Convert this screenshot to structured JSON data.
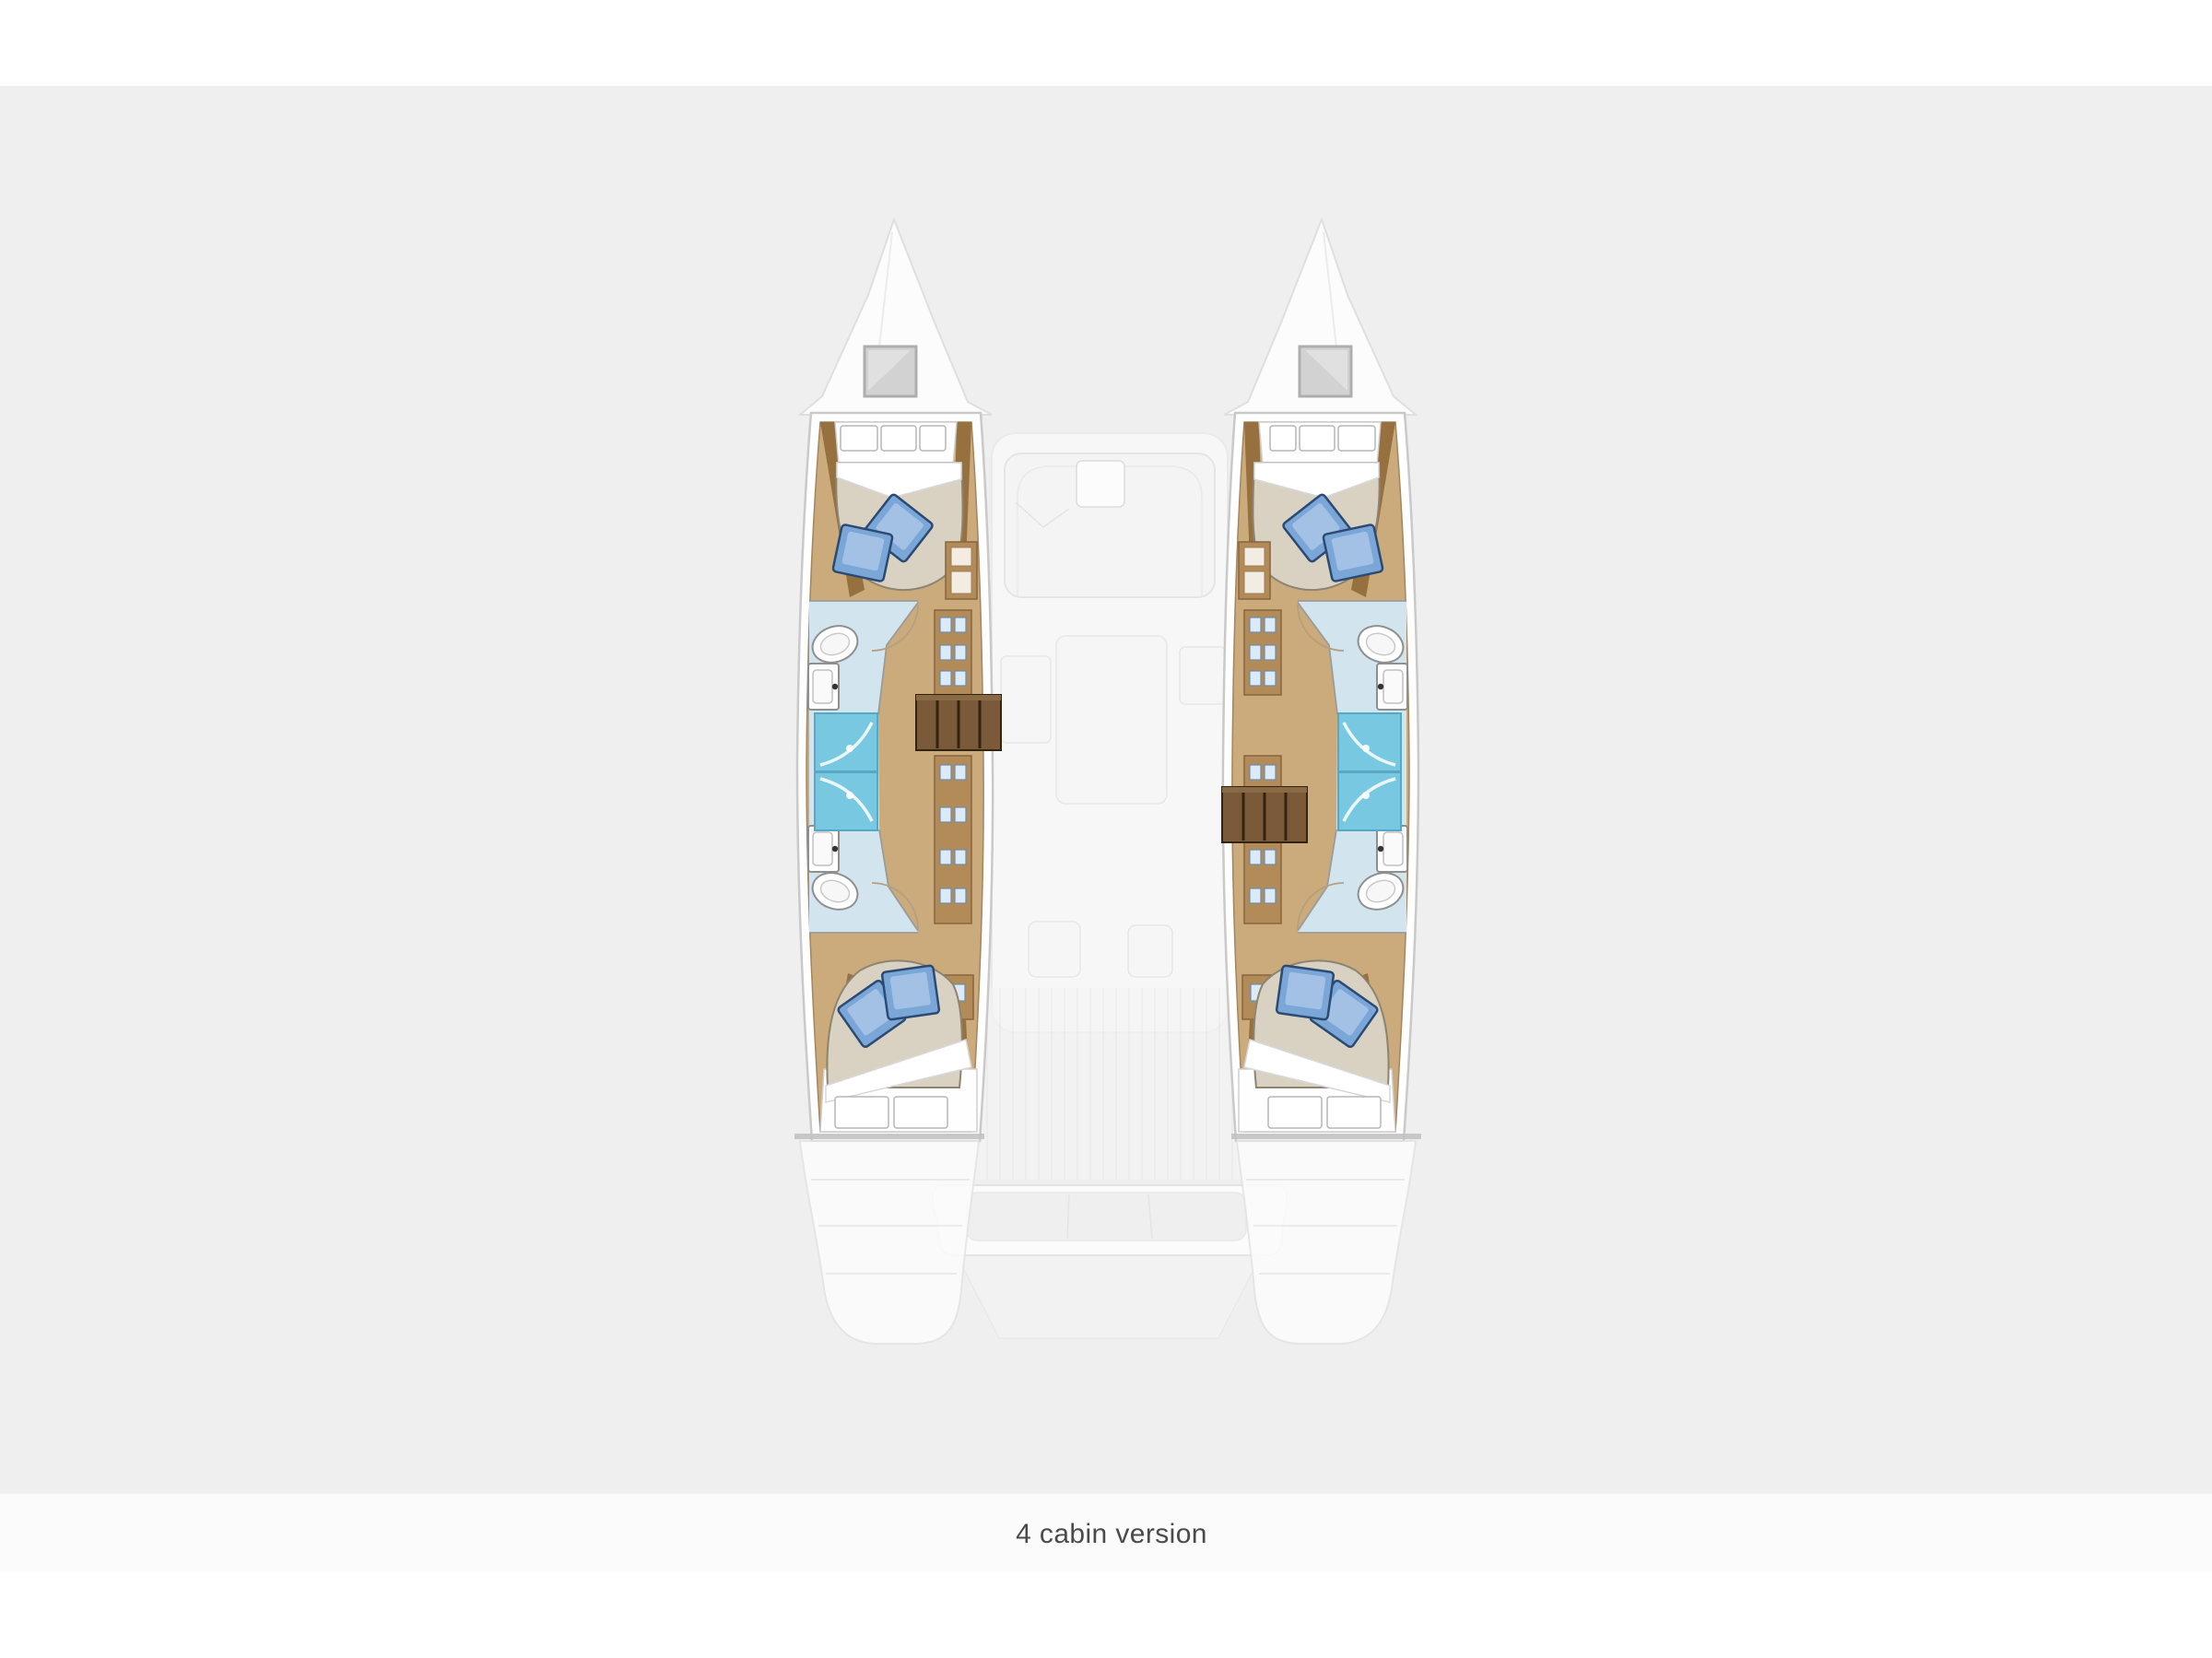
{
  "page": {
    "background": "#ffffff",
    "canvas_band_color": "#efefef",
    "caption_strip_color": "#fbfbfb"
  },
  "caption": {
    "text": "4 cabin version",
    "color": "#4a4a4a",
    "font_size_px": 30
  },
  "colors": {
    "canvas": "#efefef",
    "capstrip": "#fbfbfb",
    "caption": "#4a4a4a",
    "hull": "#ffffff",
    "hullline": "#c9c9c9",
    "wood": "#cbaa7c",
    "trim": "#96713f",
    "cab": "#b28b58",
    "stairs": "#7a5a38",
    "stairline": "#332412",
    "matt": "#d9d2c3",
    "mattline": "#8d8471",
    "bath": "#d2e5ef",
    "shower": "#79c8e2",
    "showerline": "#57a8c4",
    "fixline": "#8f8f8f",
    "wall": "#9b9b9b",
    "door": "#b5a07e",
    "pillow": "#ffffff",
    "bpill": "#7aa6d8",
    "bpilllight": "#a9c6e8",
    "bpilldark": "#2c4a72",
    "ghost": "#f6f6f6",
    "ghostline": "#e4e4e4",
    "hatch": "#d2d2d2",
    "cutline": "#c2c2c2"
  },
  "diagram": {
    "type": "boat-floor-plan",
    "vessel": "sailing catamaran, top view, bows up",
    "version_label": "4 cabin version",
    "hulls": [
      {
        "side": "port (left)",
        "rooms": [
          "forward double cabin with beige mattress, white pillows and two blue throw pillows",
          "forward bathroom with toilet, washbasin and blue shower stall",
          "companionway corridor with storage lockers and wooden entry steps",
          "aft bathroom with toilet, washbasin and blue shower stall",
          "aft double cabin with beige mattress, white pillows and two blue throw pillows"
        ]
      },
      {
        "side": "starboard (right)",
        "rooms": [
          "forward double cabin with beige mattress, white pillows and two blue throw pillows",
          "forward bathroom with toilet, washbasin and blue shower stall",
          "companionway corridor with storage lockers and wooden entry steps",
          "aft bathroom with toilet, washbasin and blue shower stall",
          "aft double cabin with beige mattress, white pillows and two blue throw pillows"
        ]
      }
    ],
    "ghosted_areas": [
      "bow foredecks with gray deck hatches",
      "saloon with sofa and table",
      "galley units",
      "cockpit bench seating",
      "transom platform and stern steps"
    ]
  }
}
